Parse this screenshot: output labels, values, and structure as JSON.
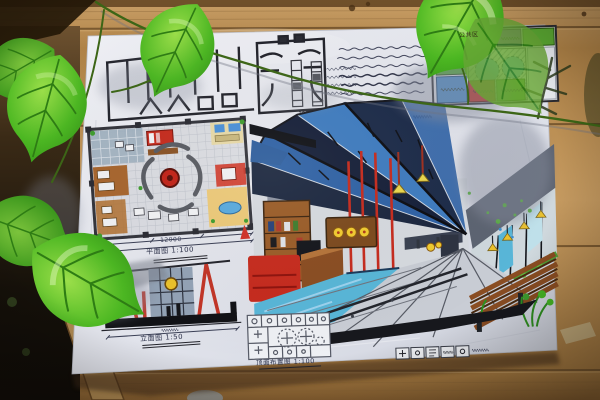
{
  "scene": {
    "type": "photograph",
    "subject": "hand-drawn interior design presentation board (marker rendering) lying on wooden boards, partly covered by artificial green vine leaves"
  },
  "palette": {
    "wood": "#b98e58",
    "wood_dark": "#6e4e28",
    "paper": "#e6e8ee",
    "leaf_green": "#54c028",
    "leaf_green_dark": "#2f8c18",
    "ink": "#23242c",
    "marker_blue": "#2f62a6",
    "marker_sky": "#58b6d8",
    "marker_red": "#c62b1e",
    "marker_orange": "#e8872a",
    "marker_purple": "#7a4fa0",
    "marker_green": "#55a42e",
    "marker_yellow": "#ecc22c",
    "marker_brown": "#8a4d22",
    "marker_gray": "#9096a4"
  },
  "board": {
    "floor_plan": {
      "caption": "平面图 1:100",
      "total_dimension": "12000"
    },
    "elevation": {
      "caption": "立面图 1:50"
    },
    "ceiling_plan": {
      "caption": "顶面布置图 1:100"
    },
    "zoning_diagram": {
      "public_zone_label": "公共区"
    }
  }
}
